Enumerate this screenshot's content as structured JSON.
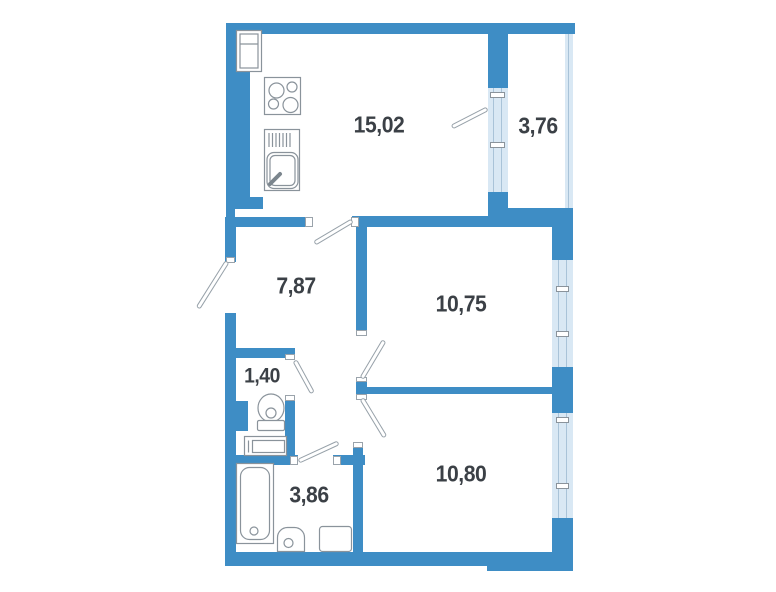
{
  "plan": {
    "title": "apartment-floor-plan",
    "rooms": {
      "kitchen_living": {
        "label": "15,02"
      },
      "balcony": {
        "label": "3,76"
      },
      "hallway": {
        "label": "7,87"
      },
      "bedroom_1": {
        "label": "10,75"
      },
      "wc": {
        "label": "1,40"
      },
      "bedroom_2": {
        "label": "10,80"
      },
      "bathroom": {
        "label": "3,86"
      }
    },
    "fixtures": [
      "fridge-icon",
      "stove-icon",
      "kitchen-sink-icon",
      "toilet-icon",
      "washbasin-icon",
      "bathtub-icon",
      "washing-machine-icon",
      "entrance-door-icon",
      "balcony-door-icon"
    ],
    "colors": {
      "wall": "#3E8DC5",
      "window_fill": "#D9E8F4",
      "glass_line": "#A9C3D8",
      "fixture_line": "#8A939B",
      "door_line": "#97A1A9",
      "label_text": "#3B4046",
      "background": "#FFFFFF"
    }
  }
}
